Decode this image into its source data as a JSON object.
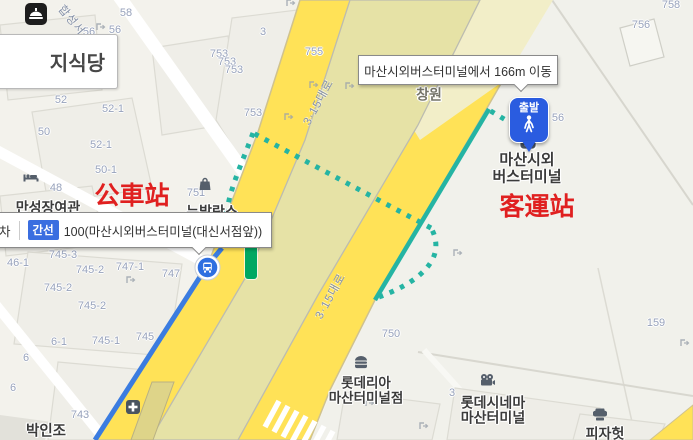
{
  "tooltips": {
    "route_info": "마산시외버스터미널에서 166m 이동",
    "boarding_prefix": "차",
    "boarding_badge": "간선",
    "boarding_text": "100(마산시외버스터미널(대신서점앞))"
  },
  "markers": {
    "departure_pin_label": "출발",
    "terminal_line1": "마산시외",
    "terminal_line2": "버스터미널"
  },
  "annotations": {
    "bus_stop_cn": "公車站",
    "terminal_cn": "客運站",
    "color": "#e02020"
  },
  "pois": [
    {
      "id": "manseongjang-inn",
      "icon": "lodging-icon",
      "ix": 31,
      "iy": 177,
      "lines": [
        "만성장여관"
      ],
      "tx": 48,
      "ty": 208,
      "fs": 14
    },
    {
      "id": "newbalance-store",
      "icon": "shopping-bag-icon",
      "ix": 205,
      "iy": 184,
      "lines": [
        "뉴발란스"
      ],
      "tx": 212,
      "ty": 212,
      "fs": 14
    },
    {
      "id": "lotteria-masan-terminal",
      "icon": "burger-icon",
      "ix": 361,
      "iy": 362,
      "lines": [
        "롯데리아",
        "마산터미널점"
      ],
      "tx": 366,
      "ty": 383,
      "fs": 13.5
    },
    {
      "id": "lotte-cinema-masan-terminal",
      "icon": "movie-camera-icon",
      "ix": 487,
      "iy": 380,
      "lines": [
        "롯데시네마",
        "마산터미널"
      ],
      "tx": 493,
      "ty": 403,
      "fs": 14
    },
    {
      "id": "pizza-hut",
      "icon": "chef-hat-icon",
      "ix": 600,
      "iy": 415,
      "lines": [
        "피자헛"
      ],
      "tx": 605,
      "ty": 434,
      "fs": 14
    },
    {
      "id": "park-injo-clinic",
      "icon": "medical-cross-icon",
      "ix": 133,
      "iy": 407,
      "lines": [
        "박인조"
      ],
      "tx": 46,
      "ty": 432,
      "fs": 14.5
    },
    {
      "id": "changwon-area",
      "lines": [
        "창원"
      ],
      "tx": 429,
      "ty": 95,
      "fs": 14,
      "muted": true
    }
  ],
  "restaurant_label": "지식당",
  "road_labels": [
    {
      "text": "3·15대로",
      "x": 318,
      "y": 102,
      "rot": -61
    },
    {
      "text": "3·15대로",
      "x": 330,
      "y": 296,
      "rot": -61
    },
    {
      "text": "합성서",
      "x": 72,
      "y": 20,
      "rot": 50
    }
  ],
  "parcel_numbers": [
    {
      "t": "58",
      "x": 126,
      "y": 13
    },
    {
      "t": "758",
      "x": 671,
      "y": 5
    },
    {
      "t": "56",
      "x": 89,
      "y": 32
    },
    {
      "t": "56",
      "x": 115,
      "y": 30
    },
    {
      "t": "54",
      "x": 73,
      "y": 77
    },
    {
      "t": "52",
      "x": 61,
      "y": 100
    },
    {
      "t": "52-1",
      "x": 113,
      "y": 109
    },
    {
      "t": "50",
      "x": 44,
      "y": 132
    },
    {
      "t": "52-1",
      "x": 101,
      "y": 145
    },
    {
      "t": "50-1",
      "x": 106,
      "y": 170
    },
    {
      "t": "48",
      "x": 56,
      "y": 188
    },
    {
      "t": "745-3",
      "x": 63,
      "y": 255
    },
    {
      "t": "745-2",
      "x": 90,
      "y": 270
    },
    {
      "t": "747-1",
      "x": 130,
      "y": 267
    },
    {
      "t": "747",
      "x": 171,
      "y": 274
    },
    {
      "t": "46-1",
      "x": 18,
      "y": 263
    },
    {
      "t": "745-2",
      "x": 58,
      "y": 288
    },
    {
      "t": "745-2",
      "x": 92,
      "y": 306
    },
    {
      "t": "6-1",
      "x": 59,
      "y": 342
    },
    {
      "t": "745-1",
      "x": 106,
      "y": 341
    },
    {
      "t": "745",
      "x": 145,
      "y": 337
    },
    {
      "t": "6",
      "x": 26,
      "y": 358
    },
    {
      "t": "6",
      "x": 13,
      "y": 388
    },
    {
      "t": "743",
      "x": 80,
      "y": 415
    },
    {
      "t": "750",
      "x": 391,
      "y": 334
    },
    {
      "t": "159",
      "x": 656,
      "y": 323
    },
    {
      "t": "756",
      "x": 641,
      "y": 25
    },
    {
      "t": "755",
      "x": 314,
      "y": 52
    },
    {
      "t": "753",
      "x": 219,
      "y": 54
    },
    {
      "t": "753",
      "x": 227,
      "y": 62
    },
    {
      "t": "753",
      "x": 234,
      "y": 70
    },
    {
      "t": "753",
      "x": 253,
      "y": 113
    },
    {
      "t": "3",
      "x": 263,
      "y": 32
    },
    {
      "t": "3",
      "x": 452,
      "y": 393
    },
    {
      "t": "56",
      "x": 558,
      "y": 118
    },
    {
      "t": "751",
      "x": 196,
      "y": 193
    }
  ],
  "entrance_icons": [
    [
      101,
      27
    ],
    [
      291,
      3
    ],
    [
      314,
      85
    ],
    [
      289,
      117
    ],
    [
      80,
      61
    ],
    [
      11,
      74
    ],
    [
      131,
      280
    ],
    [
      458,
      253
    ],
    [
      370,
      403
    ],
    [
      685,
      343
    ],
    [
      350,
      86
    ],
    [
      424,
      426
    ]
  ],
  "colors": {
    "road_yellow": "#ffe257",
    "road_center_olive": "#e6e2a6",
    "walking_route_teal": "#25b4a3",
    "bus_route_blue": "#3b7ce0",
    "line_badge_blue": "#3a6ee0",
    "stop_name_green": "#00a862",
    "annotation_red": "#e02020"
  }
}
